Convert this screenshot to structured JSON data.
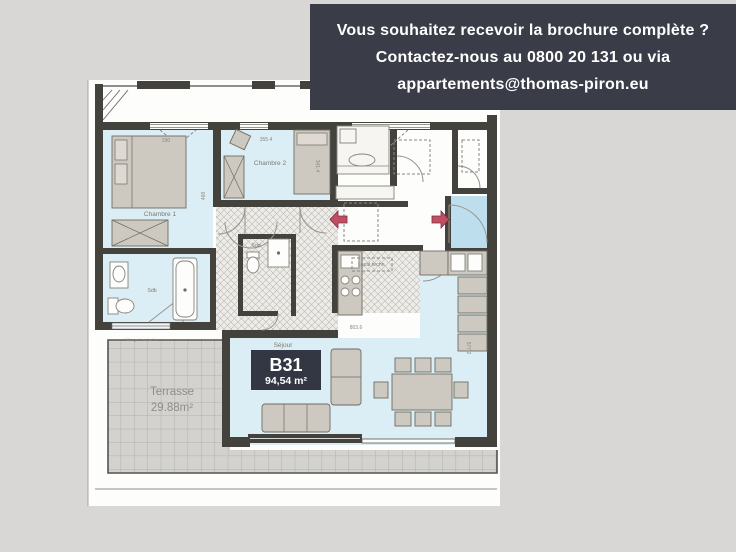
{
  "banner": {
    "line1": "Vous souhaitez recevoir la brochure complète ?",
    "line2": "Contactez-nous au 0800 20 131 ou via",
    "line3": "appartements@thomas-piron.eu"
  },
  "unit": {
    "code": "B31",
    "area": "94,54 m²"
  },
  "rooms": {
    "chambre1": "Chambre 1",
    "chambre2": "Chambre 2",
    "sdb": "Sdb",
    "sdd": "Sdd",
    "sejour": "Séjour",
    "local_technique": "Local techn.",
    "terrasse": "Terrasse",
    "terrasse_area": "29.88m²"
  },
  "annotations": {
    "vitrage": "Vitrage translucide"
  },
  "dimensions": {
    "chambre1_width": "290",
    "chambre1_depth": "468",
    "chambre2_width": "355.4",
    "chambre2_depth": "341.4",
    "sejour_width": "803.6",
    "sejour_depth": "577.2"
  },
  "colors": {
    "background": "#d8d7d5",
    "banner_bg": "#3a3d48",
    "banner_text": "#ffffff",
    "sheet": "#fdfdfc",
    "room_fill": "#dceef5",
    "entry_fill": "#bcdeed",
    "unit_box": "#333744",
    "arrow": "#c14f63",
    "terrace_fill": "#d3d2cf"
  }
}
